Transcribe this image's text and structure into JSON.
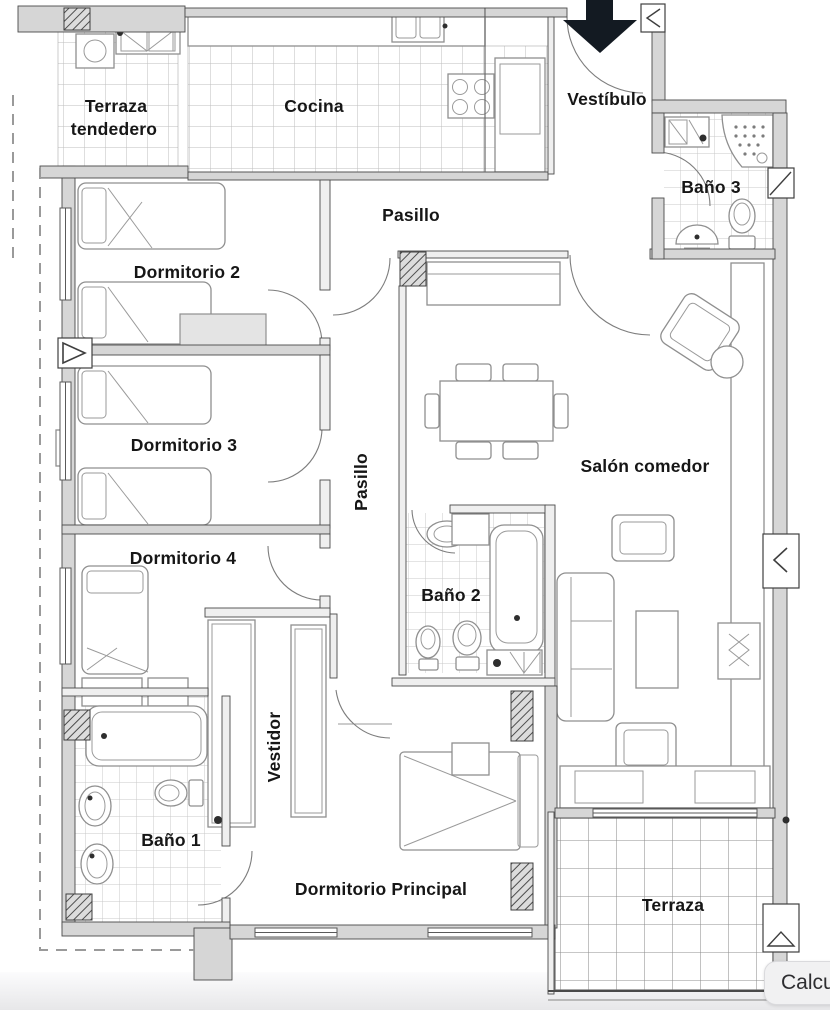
{
  "rooms": {
    "terraza_tendedero_l1": "Terraza",
    "terraza_tendedero_l2": "tendedero",
    "cocina": "Cocina",
    "vestibulo": "Vestíbulo",
    "bano3": "Baño 3",
    "pasillo_top": "Pasillo",
    "dormitorio2": "Dormitorio 2",
    "dormitorio3": "Dormitorio 3",
    "pasillo_mid": "Pasillo",
    "salon_comedor": "Salón comedor",
    "dormitorio4": "Dormitorio 4",
    "bano2": "Baño 2",
    "vestidor": "Vestidor",
    "bano1": "Baño 1",
    "dormitorio_principal": "Dormitorio Principal",
    "terraza": "Terraza"
  },
  "controls": {
    "calculate_button_label": "Calcu"
  },
  "icons": {
    "entrance_arrow": "entrance-down-arrow"
  },
  "colors": {
    "wall": "#d6d6d6",
    "line": "#4a4a4a",
    "furniture": "#8f8f8f",
    "label": "#161616",
    "arrow": "#131a22",
    "dashed_boundary": "#9a9a9a",
    "button_bg": "#f1f1f2",
    "button_text": "#2e2e31",
    "page_fade": "#e7e7e9"
  }
}
